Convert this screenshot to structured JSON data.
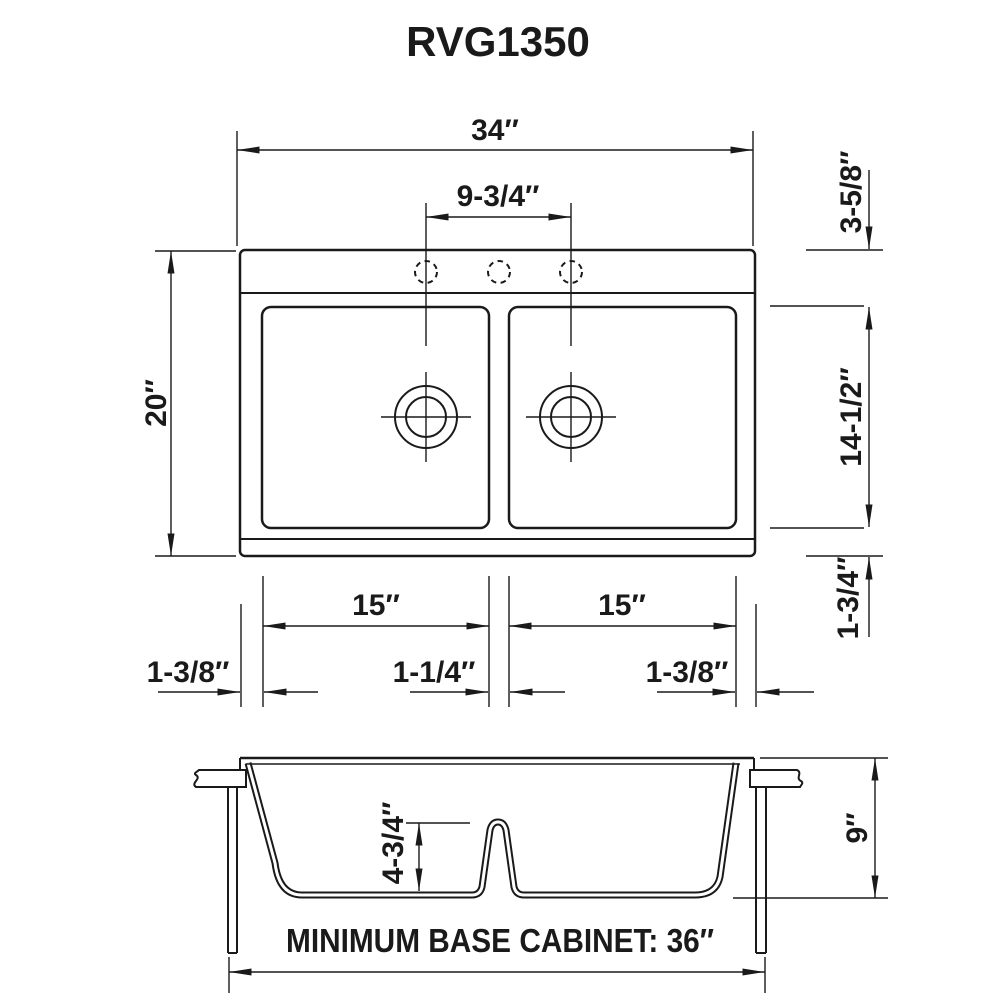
{
  "title": "RVG1350",
  "colors": {
    "ink": "#1a1a1a",
    "paper": "#ffffff"
  },
  "top_view": {
    "overall_width": "34″",
    "faucet_hole_spacing": "9-3/4″",
    "overall_front_to_back": "20″",
    "deck_to_bowl": "3-5/8″",
    "bowl_front_to_back": "14-1/2″",
    "bowl_to_front_edge": "1-3/4″",
    "left_bowl_width": "15″",
    "right_bowl_width": "15″",
    "left_edge_to_bowl": "1-3/8″",
    "divider_width": "1-1/4″",
    "bowl_to_right_edge": "1-3/8″"
  },
  "section_view": {
    "divider_height": "4-3/4″",
    "bowl_depth": "9″",
    "cabinet_note": "MINIMUM BASE CABINET: 36″"
  }
}
